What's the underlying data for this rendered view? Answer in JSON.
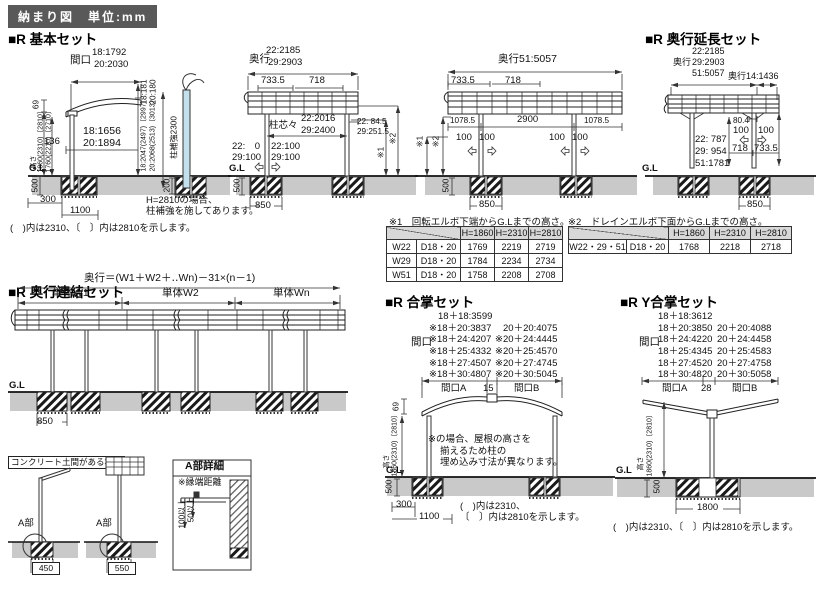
{
  "header": {
    "badge": "納まり図　単位:mm"
  },
  "sections": {
    "basic": "■R 基本セット",
    "ext": "■R 奥行延長セット",
    "renketsu": "■R 奥行連結セット",
    "gassho": "■R 合掌セット",
    "ygassho": "■R Y合掌セット"
  },
  "basic_front": {
    "maguchi": "間口",
    "maguchi_18": "18:1792",
    "maguchi_20": "20:2030",
    "eave_18": "18:181",
    "eave_20": "20:180",
    "dim_69": "69",
    "dim_136": "136",
    "inner_18": "18:1656",
    "inner_20": "20:1894",
    "takasa": "高さ",
    "h_outer": "1860(2310)〔2810〕",
    "h_inner": "1760(2210)〔2710〕",
    "right_18": "18:2047(2497)〔2997〕",
    "right_20": "20:2068(2513)〔3013〕",
    "gl": "G.L",
    "dim_500": "500",
    "dim_300": "300",
    "dim_1100": "1100",
    "pillar": "柱補強2300",
    "dim_200": "200",
    "note1": "H=2810の場合、",
    "note2": "柱補強を施してあります。",
    "paren_note": "(　)内は2310、〔　〕内は2810を示します。"
  },
  "side22": {
    "okuyuki": "奥行",
    "d22": "22:2185",
    "d29": "29:2903",
    "dim_7335": "733.5",
    "dim_718": "718",
    "chushin": "柱芯々",
    "shin22": "22:2016",
    "shin29": "29:2400",
    "r22": "22: 84.5",
    "r29": "29:251.5",
    "l22": "22:　0",
    "l29": "29:100",
    "m22": "22:100",
    "m29": "29:100",
    "mark1": "※1",
    "mark2": "※2",
    "gl": "G.L",
    "dim_500": "500",
    "dim_850": "850"
  },
  "side51": {
    "okuyuki": "奥行51:5057",
    "dim_7335": "733.5",
    "dim_718": "718",
    "dim_1078l": "1078.5",
    "dim_2900": "2900",
    "dim_1078r": "1078.5",
    "dim_100": "100",
    "mark1": "※1",
    "mark2": "※2",
    "dim_500": "500",
    "dim_850": "850"
  },
  "ext": {
    "okuyuki": "奥行",
    "d22": "22:2185",
    "d29": "29:2903",
    "d51": "51:5057",
    "okuyuki14": "奥行14:1436",
    "dim_804": "80.4",
    "dim_100": "100",
    "dim_718": "718",
    "dim_7335": "733.5",
    "h22": "22: 787",
    "h29": "29: 954",
    "h51": "51:1781",
    "gl": "G.L",
    "dim_850": "850"
  },
  "table1": {
    "caption": "※1　回転エルボ下端からG.Lまでの高さ。",
    "headers": [
      "H=1860",
      "H=2310",
      "H=2810"
    ],
    "rows": [
      [
        "W22",
        "D18・20",
        "1769",
        "2219",
        "2719"
      ],
      [
        "W29",
        "D18・20",
        "1784",
        "2234",
        "2734"
      ],
      [
        "W51",
        "D18・20",
        "1758",
        "2208",
        "2708"
      ]
    ]
  },
  "table2": {
    "caption": "※2　ドレインエルボ下面からG.Lまでの高さ。",
    "headers": [
      "H=1860",
      "H=2310",
      "H=2810"
    ],
    "rows": [
      [
        "W22・29・51",
        "D18・20",
        "1768",
        "2218",
        "2718"
      ]
    ]
  },
  "renketsu": {
    "formula": "奥行＝(W1＋W2＋‥Wn)－31×(n－1)",
    "w1": "単体W1",
    "w2": "単体W2",
    "wn": "単体Wn",
    "gl": "G.L",
    "dim_850": "850"
  },
  "concrete": {
    "box_label": "コンクリート土間がある場合",
    "a_label": "A部",
    "dim_450": "450",
    "dim_550": "550",
    "detail_title": "A部詳細",
    "edge_note": "※縁端距離",
    "dim_100up": "100以上",
    "dim_50up": "50以上"
  },
  "gassho": {
    "maguchi": "間口",
    "col1": [
      "18＋18:3599",
      "※18＋20:3837",
      "※18＋24:4207",
      "※18＋25:4332",
      "※18＋27:4507",
      "※18＋30:4807"
    ],
    "col2": [
      "20＋20:4075",
      "※20＋24:4445",
      "※20＋25:4570",
      "※20＋27:4745",
      "※20＋30:5045"
    ],
    "spanA": "間口A",
    "gap": "15",
    "spanB": "間口B",
    "dim_69": "69",
    "takasa": "高さ",
    "h_v": "1860(2310)〔2810〕",
    "note1": "※の場合、屋根の高さを",
    "note2": "揃えるため柱の",
    "note3": "埋め込み寸法が異なります。",
    "gl": "G.L",
    "dim_500": "500",
    "dim_300": "300",
    "dim_1100": "1100",
    "paren1": "(　)内は2310、",
    "paren2": "〔　〕内は2810を示します。"
  },
  "ygassho": {
    "maguchi": "間口",
    "col1": [
      "18＋18:3612",
      "18＋20:3850",
      "18＋24:4220",
      "18＋25:4345",
      "18＋27:4520",
      "18＋30:4820"
    ],
    "col2": [
      "20＋20:4088",
      "20＋24:4458",
      "20＋25:4583",
      "20＋27:4758",
      "20＋30:5058"
    ],
    "spanA": "間口A",
    "gap": "28",
    "spanB": "間口B",
    "takasa": "高さ",
    "h_v": "1860(2310)〔2810〕",
    "gl": "G.L",
    "dim_500": "500",
    "dim_1800": "1800",
    "paren_note": "(　)内は2310、〔　〕内は2810を示します。"
  }
}
